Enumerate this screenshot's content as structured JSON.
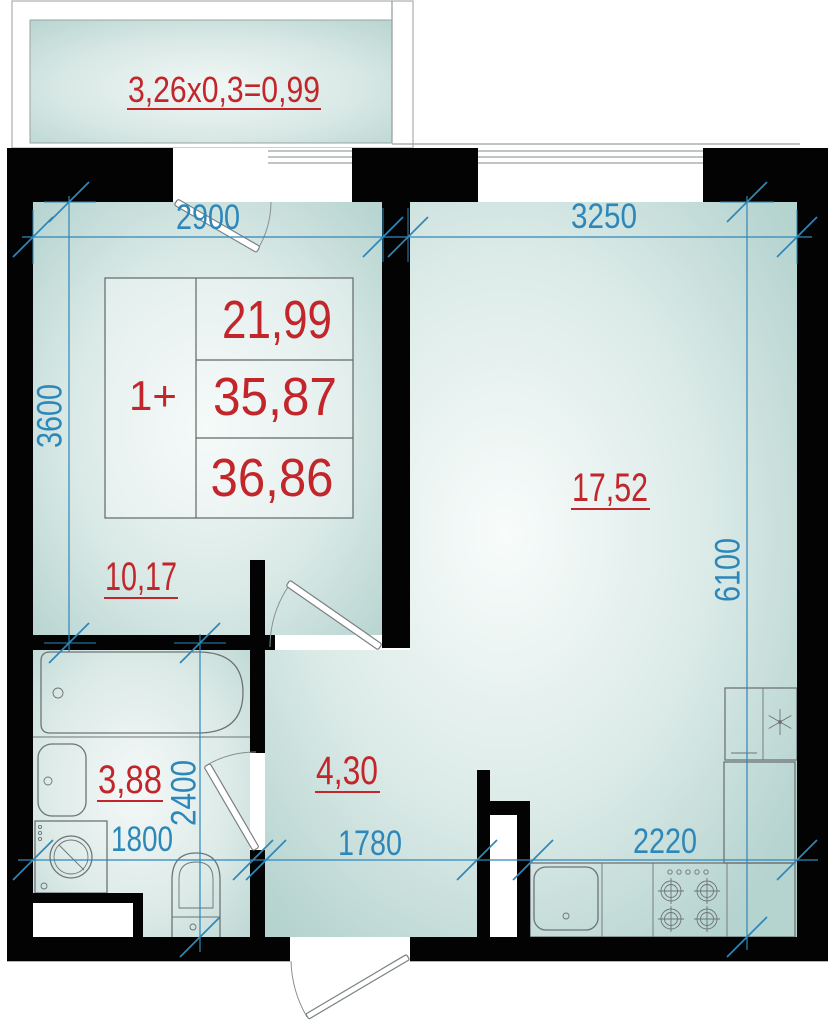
{
  "plan": {
    "balcony_formula": "3,26x0,3=0,99",
    "unit": {
      "type": "1+",
      "values": [
        "21,99",
        "35,87",
        "36,86"
      ]
    },
    "areas": {
      "bedroom": "10,17",
      "living": "17,52",
      "bathroom": "3,88",
      "hallway": "4,30"
    },
    "dims": {
      "bedroom_width": "2900",
      "living_width": "3250",
      "bedroom_depth": "3600",
      "living_depth": "6100",
      "bathroom_depth": "2400",
      "bathroom_width": "1800",
      "hallway_width": "1780",
      "kitchen_width": "2220"
    }
  },
  "colors": {
    "dimension_blue": "#2e87b9",
    "area_red": "#c2262b",
    "wall_black": "#030303",
    "floor_teal_edge": "#b5d3cf",
    "floor_teal_center": "#f6faf9"
  }
}
